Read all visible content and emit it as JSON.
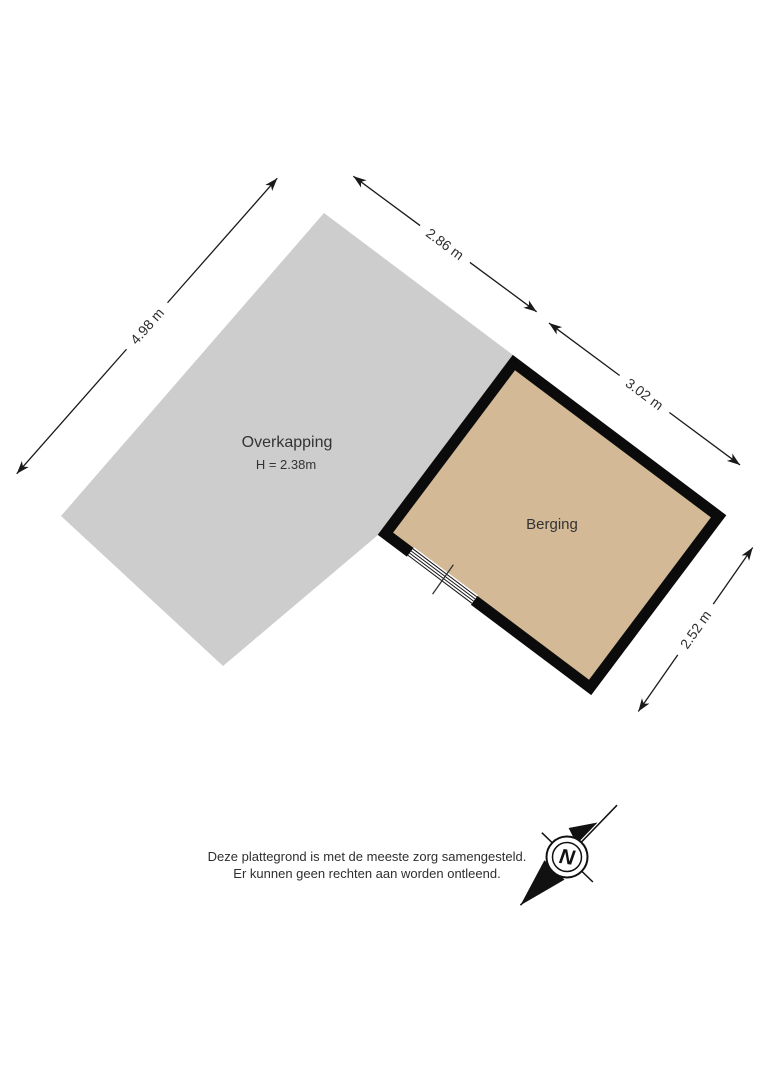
{
  "plan": {
    "rooms": [
      {
        "name": "Overkapping",
        "height_label": "H = 2.38m"
      },
      {
        "name": "Berging"
      }
    ],
    "dimensions": [
      {
        "label": "4.98 m"
      },
      {
        "label": "2.86 m"
      },
      {
        "label": "3.02 m"
      },
      {
        "label": "2.52 m"
      }
    ],
    "compass": {
      "north_label": "N"
    },
    "disclaimer": {
      "line1": "Deze plattegrond is met de meeste zorg samengesteld.",
      "line2": "Er kunnen geen rechten aan worden ontleend."
    },
    "colors": {
      "overkapping_fill": "#cdcdcd",
      "berging_fill": "#d3b996",
      "wall": "#0b0b0b"
    }
  }
}
